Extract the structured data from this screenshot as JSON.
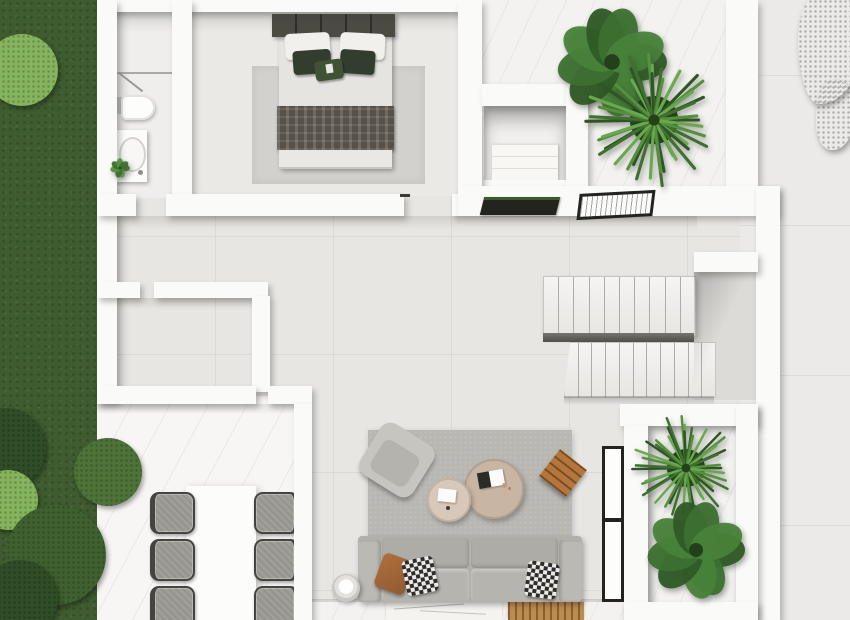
{
  "scene": {
    "kind": "architectural-floor-plan-3d-render",
    "view": "top-down",
    "style": "white-walls-minimalist",
    "rooms": [
      "garden",
      "bathroom",
      "bedroom",
      "wardrobe-niche",
      "upper-patio",
      "hallway",
      "storage-room",
      "open-living-area",
      "staircase",
      "lower-patio",
      "outdoor-dining-terrace",
      "entry-walkway"
    ]
  },
  "palette": {
    "wall": "#fafaf8",
    "floor": "#e8e6e3",
    "marble": "#f3f2f0",
    "marbleBright": "#f7f6f4",
    "pavement": "#eceae8",
    "landing": "#dcdbd8",
    "grass": "#3e5c2f",
    "hedge": "#2c4a22",
    "bushDark": "#2f4d26",
    "bushMid": "#4e7339",
    "bushLight": "#86b35e",
    "rugLiving": "#b9b7b2",
    "rugBed": "#d3d1cd",
    "sofa": "#b2b0aa",
    "cushion": "#aeaca6",
    "seat": "#b6b4ae",
    "arm": "#bbb9b3",
    "tableLg": "#c9b5a3",
    "tableSm": "#d7c8b9",
    "wood": "#b5763b",
    "woodDark": "#7a4d22",
    "bedHead": "#4b4a43",
    "pillowDark": "#333d2f",
    "pillowThrow": "#3f5233",
    "orange": "#b06f3f",
    "blanket": "#56514a",
    "duvet": "#e6e4e0",
    "chairSeat": "#a09e99",
    "chairFrame": "#454440",
    "frameDark": "#23231f",
    "stair": "#f5f4f2",
    "white": "#fcfcfb"
  },
  "stairs": {
    "upper_treads": 10,
    "lower_treads": 11
  },
  "dining": {
    "chairs_per_side": 3,
    "sides": 2,
    "table_color": "#fcfcfb"
  },
  "bed": {
    "white_pillows": 2,
    "dark_pillows": 2,
    "throw_pillows": 1
  },
  "sofa": {
    "back_cushions": 2,
    "seat_cushions": 2,
    "pillows": 3
  },
  "bathroom": {
    "fixtures": [
      "shower",
      "wall-hung-toilet",
      "vanity-sink",
      "plant"
    ]
  },
  "plants": {
    "palm": {
      "type": "palm",
      "fronds": 44,
      "core": "#24411c",
      "colors": [
        "#2e5523",
        "#3f7030",
        "#55903f",
        "#6aa84f"
      ]
    },
    "leaf": {
      "type": "leaf",
      "leaves": 9,
      "core": "#23401b",
      "colors": [
        "#2f5a26",
        "#3c7030",
        "#48823a"
      ]
    },
    "sprout": {
      "type": "leaf",
      "leaves": 7,
      "core": "#2a4a20",
      "colors": [
        "#3f7030",
        "#55903f"
      ]
    }
  }
}
